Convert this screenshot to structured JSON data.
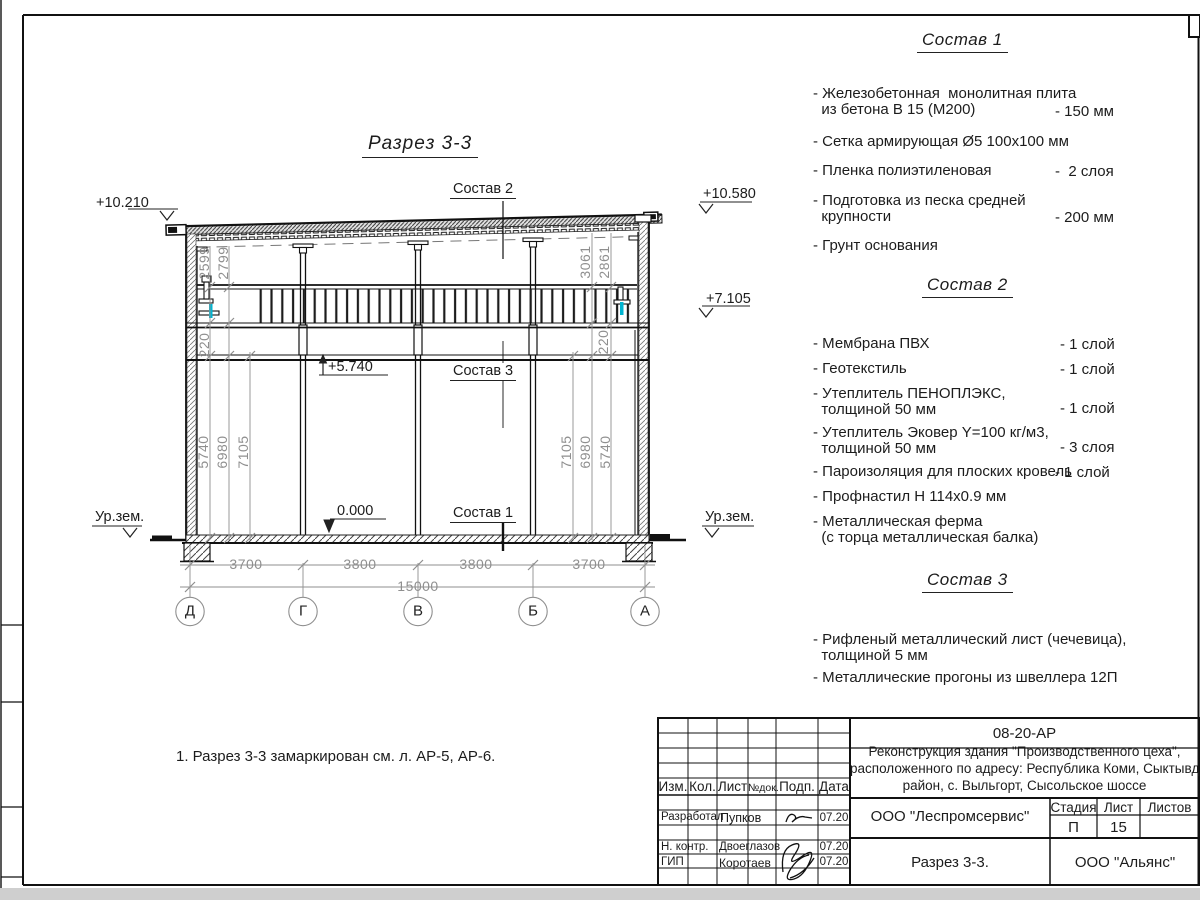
{
  "drawing_title": "Разрез 3-3",
  "note": "1. Разрез 3-3 замаркирован см. л. АР-5, АР-6.",
  "section_labels": {
    "s1": "Состав 1",
    "s2": "Состав 2",
    "s3": "Состав 3"
  },
  "elevations": {
    "left_top": "+10.210",
    "right_top": "+10.580",
    "right_mid": "+7.105",
    "mid": "+5.740",
    "zero": "0.000",
    "ground_left": "Ур.зем.",
    "ground_right": "Ур.зем."
  },
  "vertical_dims": [
    "2599",
    "2799",
    "220",
    "5740",
    "6980",
    "7105",
    "3061",
    "2861",
    "220",
    "7105",
    "6980",
    "5740"
  ],
  "horizontal_dims": [
    "3700",
    "3800",
    "3800",
    "3700"
  ],
  "total_dim": "15000",
  "axes": [
    "Д",
    "Г",
    "В",
    "Б",
    "А"
  ],
  "accent_colors": {
    "highlight": "#00b5d1",
    "dim_gray": "#8f8f8f"
  },
  "specs": [
    {
      "heading": "Состав 1",
      "items": [
        {
          "name": "- Железобетонная  монолитная плита\n  из бетона В 15 (М200)",
          "value": "- 150 мм"
        },
        {
          "name": "- Сетка армирующая Ø5 100х100 мм",
          "value": ""
        },
        {
          "name": "- Пленка полиэтиленовая",
          "value": "-  2 слоя"
        },
        {
          "name": "- Подготовка из песка средней\n  крупности",
          "value": "- 200 мм"
        },
        {
          "name": "- Грунт основания",
          "value": ""
        }
      ]
    },
    {
      "heading": "Состав 2",
      "items": [
        {
          "name": "- Мембрана ПВХ",
          "value": "- 1 слой"
        },
        {
          "name": "- Геотекстиль",
          "value": "- 1 слой"
        },
        {
          "name": "- Утеплитель ПЕНОПЛЭКС,\n  толщиной 50 мм",
          "value": "- 1 слой"
        },
        {
          "name": "- Утеплитель Эковер Y=100 кг/м3,\n  толщиной 50 мм",
          "value": "- 3 слоя"
        },
        {
          "name": "- Пароизоляция для плоских кровель",
          "value": "- 1 слой"
        },
        {
          "name": "- Профнастил Н 114х0.9 мм",
          "value": ""
        },
        {
          "name": "- Металлическая ферма\n  (с торца металлическая балка)",
          "value": ""
        }
      ]
    },
    {
      "heading": "Состав 3",
      "items": [
        {
          "name": "- Рифленый металлический лист (чечевица),\n  толщиной 5 мм",
          "value": ""
        },
        {
          "name": "- Металлические прогоны из швеллера 12П",
          "value": ""
        }
      ]
    }
  ],
  "title_block": {
    "doc_code": "08-20-АР",
    "project": "Реконструкция здания \"Производственного цеха\",\nрасположенного по адресу: Республика Коми, Сыктывдинский\nрайон, с. Выльгорт, Сысольское шоссе",
    "columns": {
      "izm": "Изм.",
      "kol": "Кол.",
      "list": "Лист",
      "ndok": "№док.",
      "podp": "Подп.",
      "data": "Дата"
    },
    "rows": [
      {
        "role": "Разработал",
        "name": "Пупков",
        "date": "07.20"
      },
      {
        "role": "Н. контр.",
        "name": "Двоеглазов",
        "date": "07.20"
      },
      {
        "role": "ГИП",
        "name": "Коротаев",
        "date": "07.20"
      }
    ],
    "org": "ООО \"Леспромсервис\"",
    "stage_label": "Стадия",
    "sheet_label": "Лист",
    "sheets_label": "Листов",
    "stage": "П",
    "sheet": "15",
    "sheets": "",
    "drawing_name": "Разрез 3-3.",
    "company": "ООО \"Альянс\""
  }
}
